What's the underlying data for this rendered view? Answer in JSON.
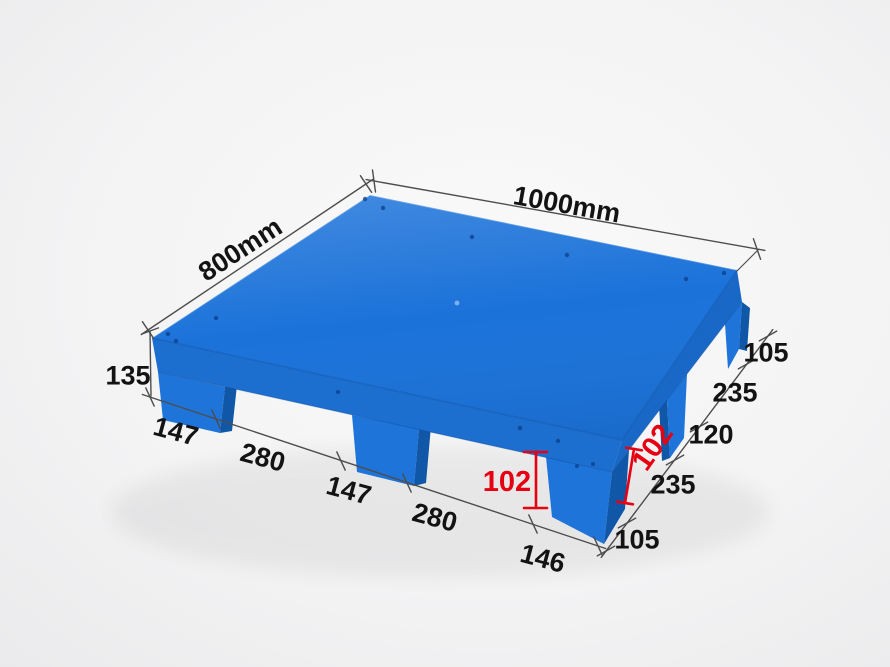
{
  "colors": {
    "background_center": "#fafafa",
    "background_edge": "#eaeaec",
    "pallet_top": "#1b72d9",
    "pallet_side_left": "#1c6ecf",
    "pallet_side_right": "#1968c8",
    "pallet_foot_front": "#1e74d8",
    "pallet_foot_side": "#1157a8",
    "pallet_edge_line": "#0f55ad",
    "dimension_line": "#4d4d4d",
    "dimension_text": "#131313",
    "dimension_red": "#e60012"
  },
  "labels": {
    "top_edge_length": "1000mm",
    "left_edge_length": "800mm",
    "overall_height": "135",
    "front_edge_segments": [
      "147",
      "280",
      "147",
      "280",
      "146"
    ],
    "right_edge_segments": [
      "105",
      "235",
      "120",
      "235",
      "105"
    ],
    "foot_height_front": "102",
    "foot_height_right": "102"
  }
}
